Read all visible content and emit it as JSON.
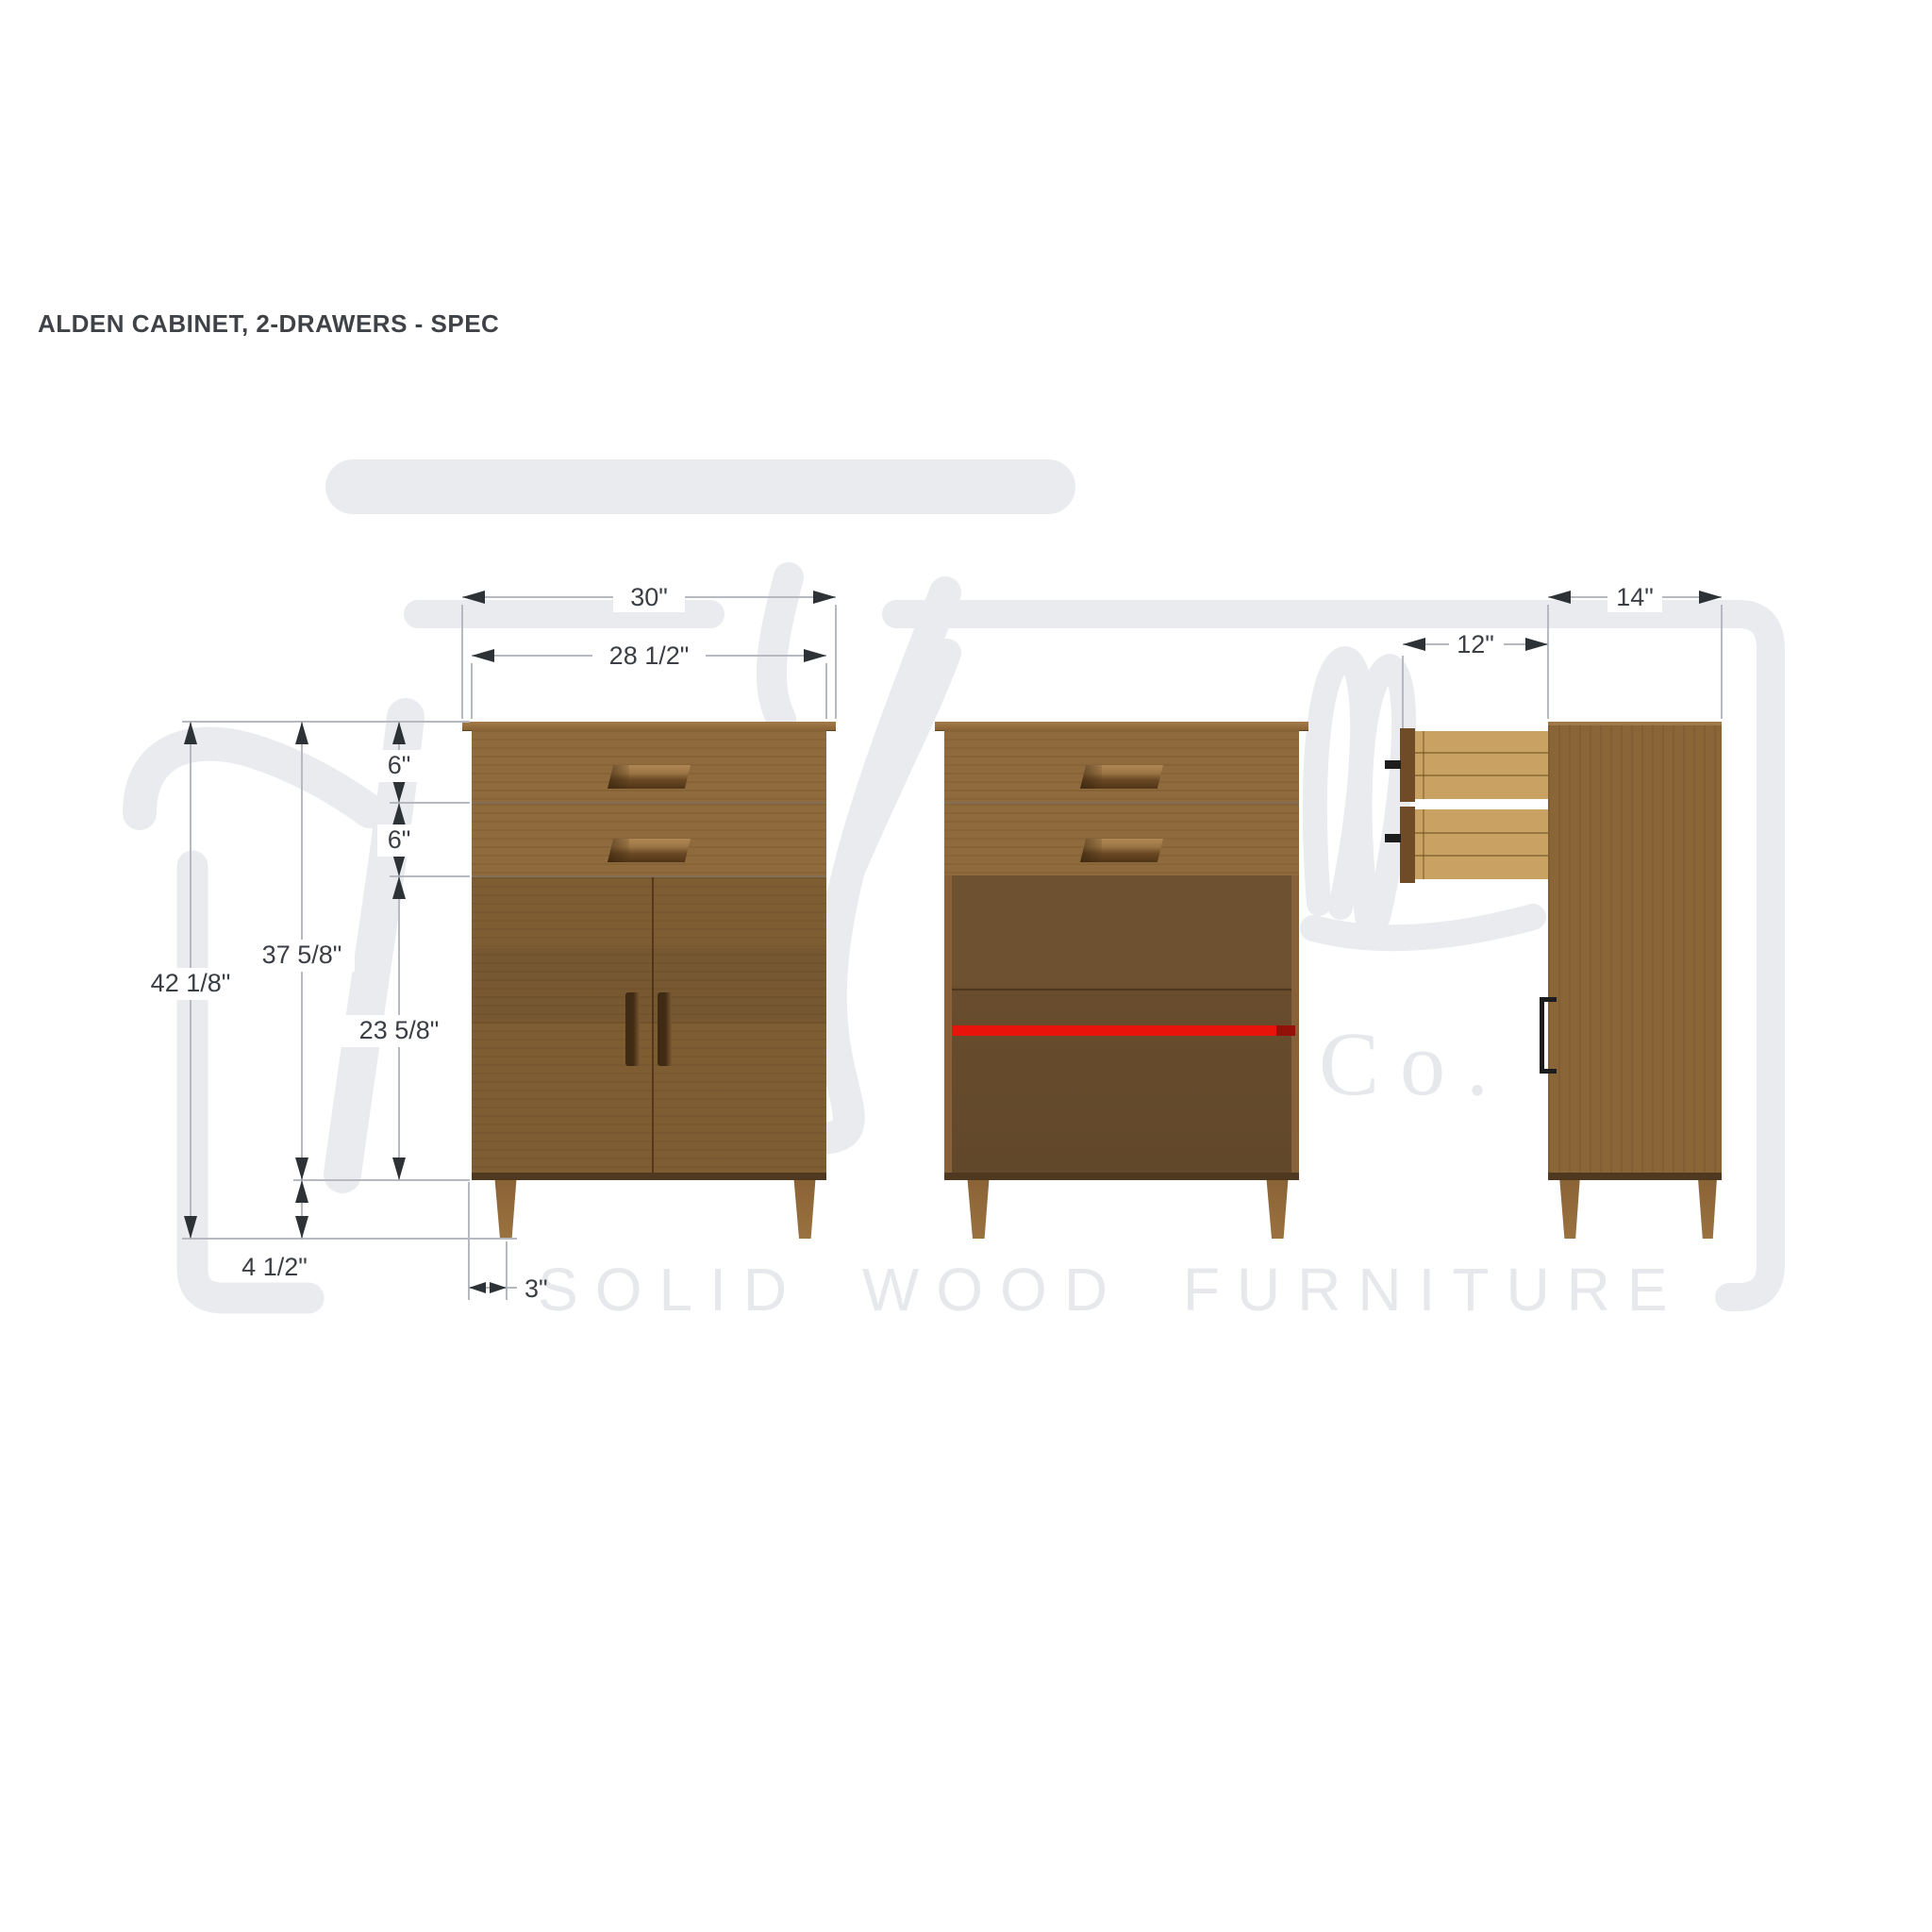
{
  "page": {
    "title": "ALDEN CABINET, 2-DRAWERS - SPEC"
  },
  "watermark": {
    "company": "Co.",
    "tagline": "SOLID WOOD FURNITURE"
  },
  "dimensions": {
    "front": {
      "overall_width": "30\"",
      "drawer_width": "28 1/2\"",
      "top_drawer_height": "6\"",
      "second_drawer_height": "6\"",
      "overall_height": "42 1/8\"",
      "carcase_height": "37 5/8\"",
      "door_section_height": "23 5/8\"",
      "leg_height": "4 1/2\"",
      "leg_inset": "3\""
    },
    "side": {
      "depth": "14\"",
      "drawer_extension": "12\""
    }
  },
  "colors": {
    "shelf_highlight_red": "#e8140c",
    "shelf_highlight_red_dark": "#941109",
    "wood_medium": "#8a6538",
    "wood_door": "#7e5d33",
    "wood_interior": "#684c2d",
    "drawer_box": "#c9a263",
    "hardware_black": "#1d1d1d",
    "dimension_line": "#b6bac0",
    "dimension_text": "#3b3f45",
    "watermark_gray": "#e9ebee"
  }
}
